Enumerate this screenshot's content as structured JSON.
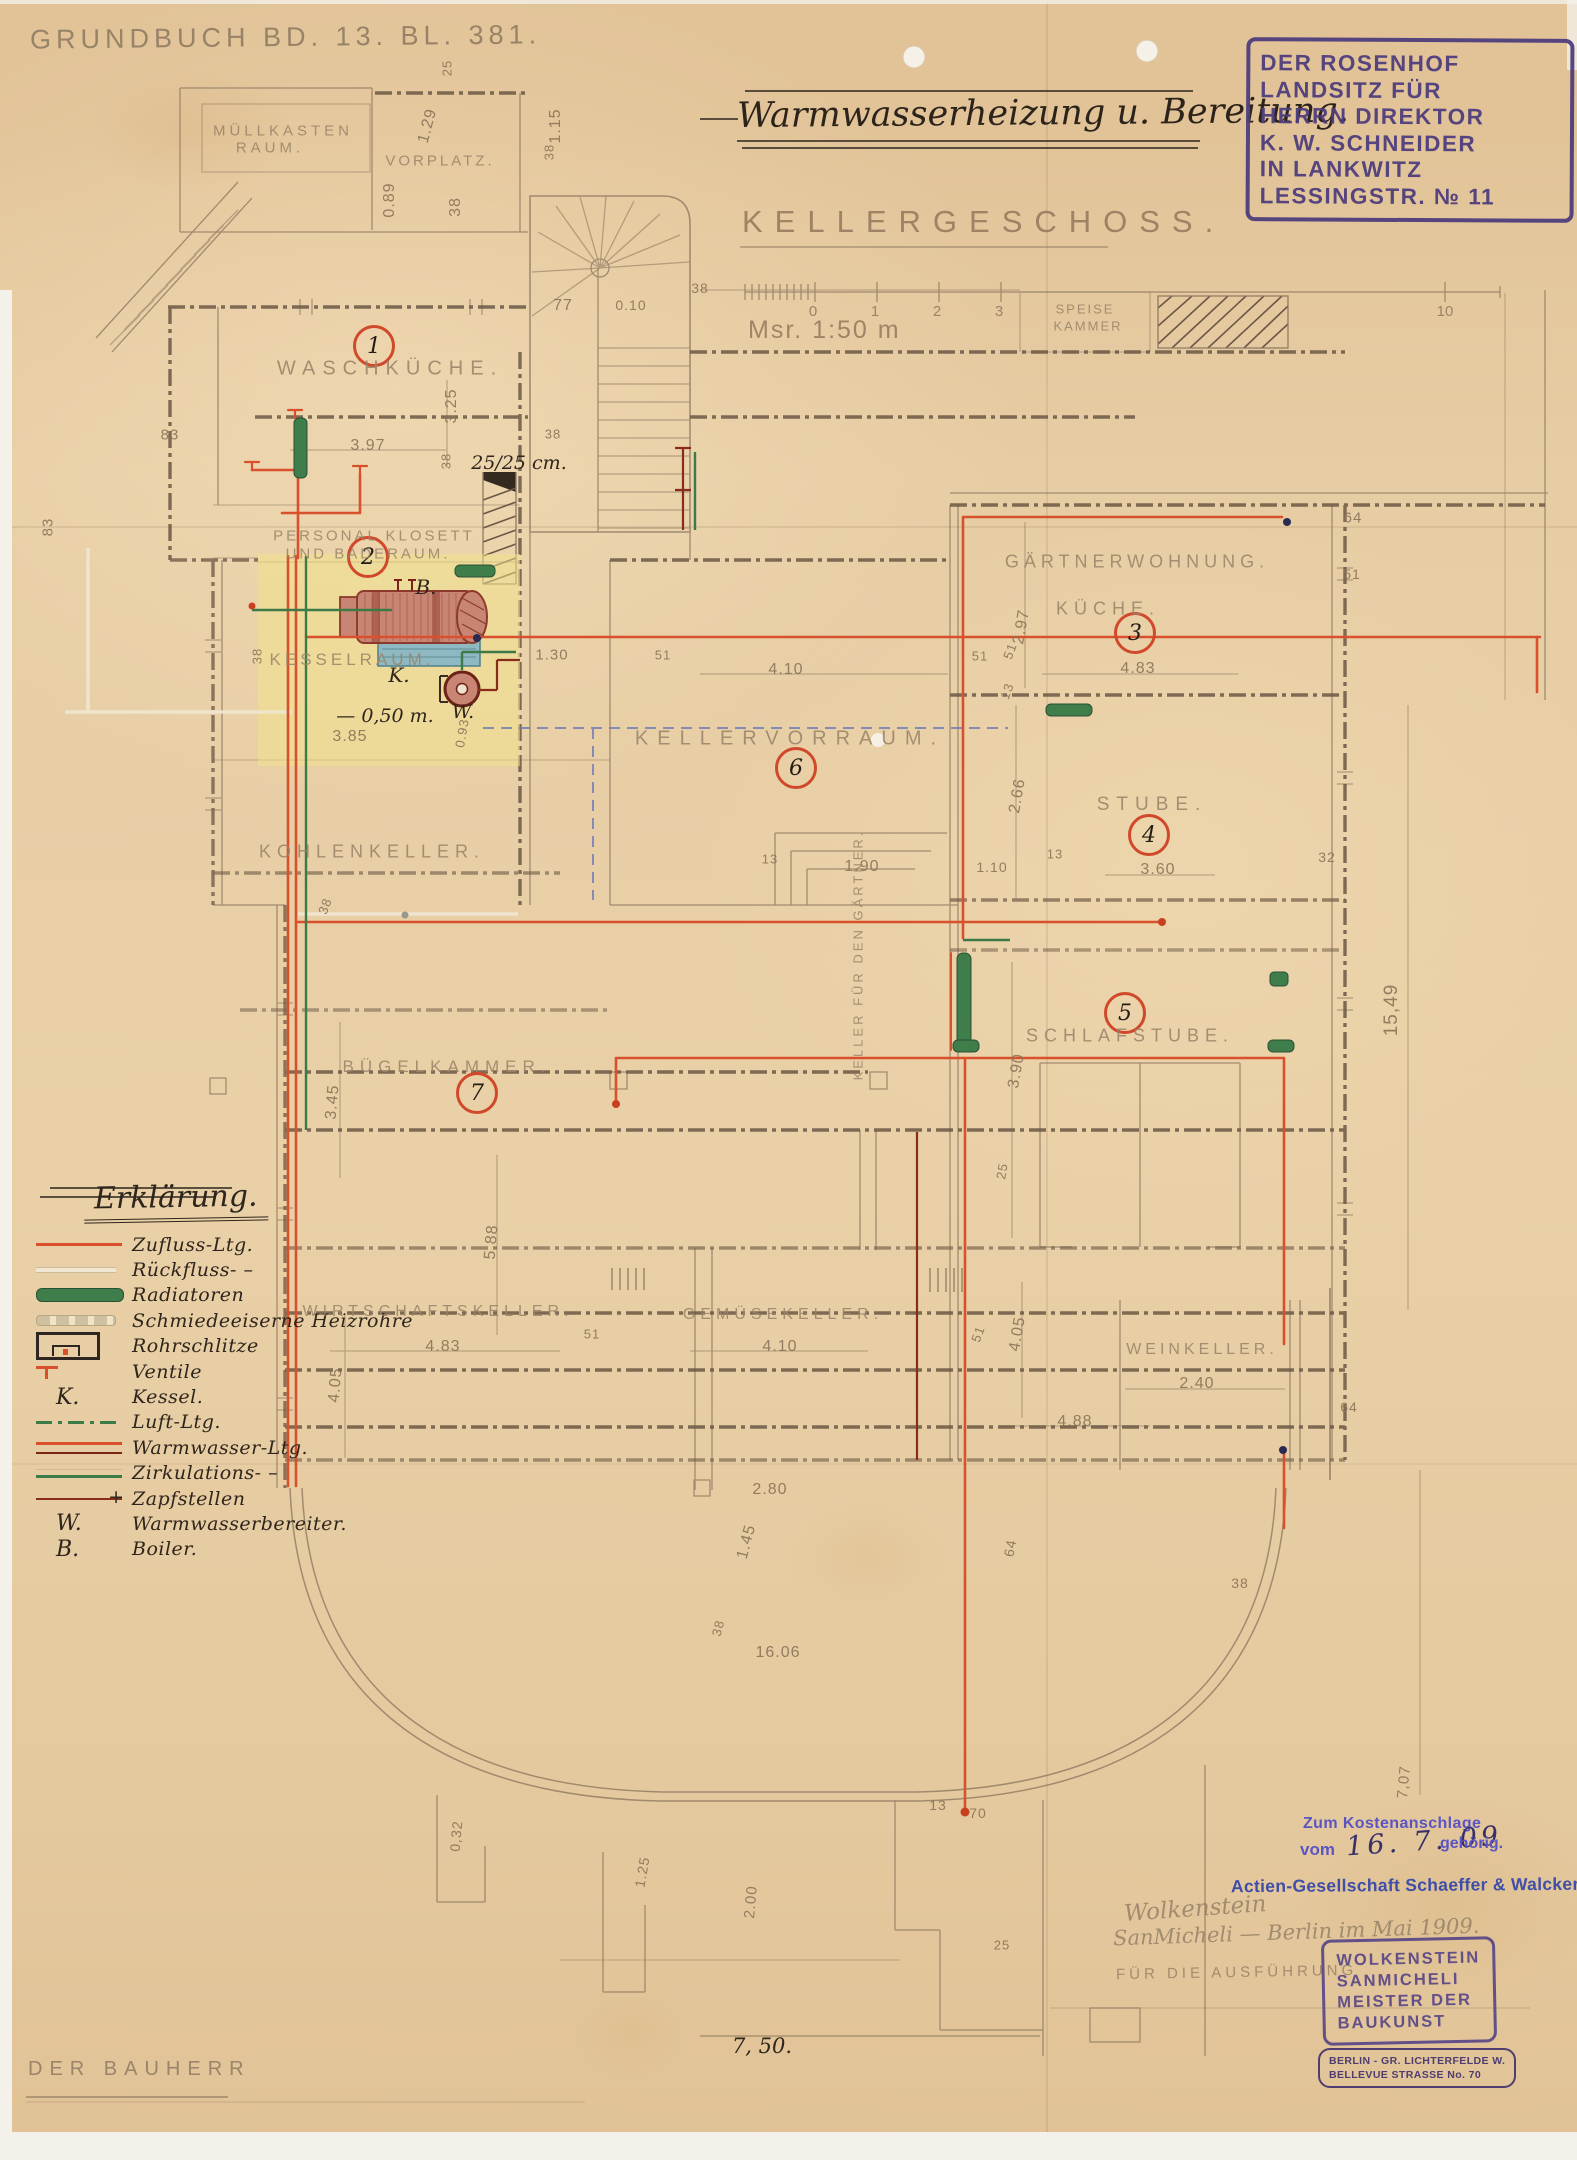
{
  "meta": {
    "grundbuch": "Grundbuch Bd. 13. Bl. 381.",
    "bauherr": "Der Bauherr"
  },
  "title": {
    "main": "Warmwasserheizung u. Bereitung.",
    "floor": "Kellergeschoss.",
    "scale": "Msr. 1:50 m",
    "scale_ticks": [
      {
        "t": "0",
        "x": 813
      },
      {
        "t": "1",
        "x": 875
      },
      {
        "t": "2",
        "x": 937
      },
      {
        "t": "3",
        "x": 999
      },
      {
        "t": "10",
        "x": 1445
      }
    ]
  },
  "owner_stamp": {
    "lines": [
      "DER ROSENHOF",
      "LANDSITZ FÜR",
      "HERRN DIREKTOR",
      "K. W. SCHNEIDER",
      "IN LANKWITZ",
      "LESSINGSTR. № 11"
    ]
  },
  "legend": {
    "title": "Erklärung.",
    "items": [
      {
        "sym": "line-red",
        "label": "Zufluss-Ltg."
      },
      {
        "sym": "line-ghost",
        "label": "Rückfluss- –"
      },
      {
        "sym": "bar-green",
        "label": "Radiatoren"
      },
      {
        "sym": "bar-gray",
        "label": "Schmiedeeiserne Heizrohre"
      },
      {
        "sym": "slit",
        "label": "Rohrschlitze"
      },
      {
        "sym": "valve",
        "label": "Ventile"
      },
      {
        "sym": "letter",
        "glyph": "K.",
        "label": "Kessel."
      },
      {
        "sym": "dashdot-green",
        "label": "Luft-Ltg."
      },
      {
        "sym": "line-red-dark",
        "label": "Warmwasser-Ltg."
      },
      {
        "sym": "line-green",
        "label": "Zirkulations- –"
      },
      {
        "sym": "tap",
        "label": "Zapfstellen"
      },
      {
        "sym": "letter",
        "glyph": "W.",
        "label": "Warmwasserbereiter."
      },
      {
        "sym": "letter",
        "glyph": "B.",
        "label": "Boiler."
      }
    ]
  },
  "plan": {
    "room_circles": [
      {
        "n": "1",
        "x": 374,
        "y": 346
      },
      {
        "n": "2",
        "x": 368,
        "y": 557
      },
      {
        "n": "3",
        "x": 1135,
        "y": 633
      },
      {
        "n": "4",
        "x": 1149,
        "y": 835
      },
      {
        "n": "5",
        "x": 1125,
        "y": 1013
      },
      {
        "n": "6",
        "x": 796,
        "y": 768
      },
      {
        "n": "7",
        "x": 477,
        "y": 1093
      }
    ],
    "room_labels": [
      {
        "t": "Müllkasten",
        "x": 283,
        "y": 131,
        "s": 15,
        "ls": 4
      },
      {
        "t": "Raum.",
        "x": 270,
        "y": 148,
        "s": 15,
        "ls": 4
      },
      {
        "t": "Vorplatz.",
        "x": 440,
        "y": 161,
        "s": 15,
        "ls": 3
      },
      {
        "t": "Waschküche.",
        "x": 390,
        "y": 369,
        "s": 20,
        "ls": 7
      },
      {
        "t": "Personal Klosett",
        "x": 374,
        "y": 536,
        "s": 15,
        "ls": 3
      },
      {
        "t": "und Baderaum.",
        "x": 368,
        "y": 554,
        "s": 15,
        "ls": 3
      },
      {
        "t": "Kesselraum.",
        "x": 352,
        "y": 660,
        "s": 17,
        "ls": 4
      },
      {
        "t": "Kohlenkeller.",
        "x": 372,
        "y": 852,
        "s": 18,
        "ls": 6
      },
      {
        "t": "Kellervorraum.",
        "x": 790,
        "y": 739,
        "s": 20,
        "ls": 9
      },
      {
        "t": "Gärtnerwohnung.",
        "x": 1137,
        "y": 562,
        "s": 18,
        "ls": 5
      },
      {
        "t": "Küche.",
        "x": 1108,
        "y": 609,
        "s": 18,
        "ls": 6
      },
      {
        "t": "Speise",
        "x": 1085,
        "y": 309,
        "s": 13,
        "ls": 2
      },
      {
        "t": "Kammer",
        "x": 1088,
        "y": 326,
        "s": 13,
        "ls": 2
      },
      {
        "t": "Stube.",
        "x": 1152,
        "y": 805,
        "s": 19,
        "ls": 7
      },
      {
        "t": "Schlafstube.",
        "x": 1130,
        "y": 1036,
        "s": 18,
        "ls": 6
      },
      {
        "t": "Bügelkammer.",
        "x": 447,
        "y": 1067,
        "s": 17,
        "ls": 6
      },
      {
        "t": "Wirtschaftskeller.",
        "x": 438,
        "y": 1312,
        "s": 16,
        "ls": 5
      },
      {
        "t": "Gemüsekeller.",
        "x": 783,
        "y": 1315,
        "s": 16,
        "ls": 5
      },
      {
        "t": "Weinkeller.",
        "x": 1202,
        "y": 1350,
        "s": 16,
        "ls": 4
      },
      {
        "t": "Keller für den Gärtner.",
        "x": 858,
        "y": 955,
        "s": 13,
        "ls": 3,
        "r": -90
      }
    ],
    "dimensions": [
      {
        "t": "0.89",
        "x": 390,
        "y": 200,
        "r": -90
      },
      {
        "t": "1.29",
        "x": 428,
        "y": 126,
        "r": -75
      },
      {
        "t": "25",
        "x": 447,
        "y": 68,
        "r": -90,
        "s": 13
      },
      {
        "t": "38",
        "x": 456,
        "y": 207,
        "r": -90
      },
      {
        "t": "1.15",
        "x": 556,
        "y": 126,
        "r": -90
      },
      {
        "t": "38",
        "x": 549,
        "y": 152,
        "r": -90,
        "s": 13
      },
      {
        "t": "77",
        "x": 563,
        "y": 306
      },
      {
        "t": "0.10",
        "x": 631,
        "y": 305,
        "s": 14
      },
      {
        "t": "38",
        "x": 700,
        "y": 288,
        "s": 14
      },
      {
        "t": "83",
        "x": 170,
        "y": 435,
        "s": 15
      },
      {
        "t": "83",
        "x": 48,
        "y": 527,
        "r": -90,
        "s": 15
      },
      {
        "t": "3.97",
        "x": 368,
        "y": 446
      },
      {
        "t": "3.25",
        "x": 452,
        "y": 406,
        "r": -90
      },
      {
        "t": "38",
        "x": 446,
        "y": 461,
        "r": -90,
        "s": 13
      },
      {
        "t": "38",
        "x": 553,
        "y": 434,
        "s": 13
      },
      {
        "t": "38",
        "x": 257,
        "y": 656,
        "r": -90,
        "s": 13
      },
      {
        "t": "3.85",
        "x": 350,
        "y": 737
      },
      {
        "t": "1.30",
        "x": 552,
        "y": 655,
        "s": 15
      },
      {
        "t": "0.93",
        "x": 462,
        "y": 733,
        "r": -80,
        "s": 13
      },
      {
        "t": "2.97",
        "x": 1022,
        "y": 627,
        "r": -80
      },
      {
        "t": "4.83",
        "x": 1138,
        "y": 669
      },
      {
        "t": "51",
        "x": 1010,
        "y": 651,
        "r": -70,
        "s": 13
      },
      {
        "t": "13",
        "x": 1007,
        "y": 691,
        "r": -70,
        "s": 13
      },
      {
        "t": "64",
        "x": 1353,
        "y": 518,
        "s": 15
      },
      {
        "t": "51",
        "x": 1352,
        "y": 574,
        "s": 14
      },
      {
        "t": "4.10",
        "x": 786,
        "y": 670
      },
      {
        "t": "51",
        "x": 663,
        "y": 655,
        "s": 13
      },
      {
        "t": "51",
        "x": 980,
        "y": 656,
        "s": 13
      },
      {
        "t": "1.90",
        "x": 862,
        "y": 867
      },
      {
        "t": "13",
        "x": 770,
        "y": 859,
        "s": 13
      },
      {
        "t": "1.10",
        "x": 992,
        "y": 867,
        "s": 14
      },
      {
        "t": "2.66",
        "x": 1018,
        "y": 796,
        "r": -80
      },
      {
        "t": "13",
        "x": 1055,
        "y": 854,
        "s": 13
      },
      {
        "t": "3.60",
        "x": 1158,
        "y": 870
      },
      {
        "t": "32",
        "x": 1327,
        "y": 857,
        "s": 14
      },
      {
        "t": "3.90",
        "x": 1017,
        "y": 1071,
        "r": -80
      },
      {
        "t": "25",
        "x": 1002,
        "y": 1171,
        "r": -80,
        "s": 13
      },
      {
        "t": "3.45",
        "x": 333,
        "y": 1102,
        "r": -85
      },
      {
        "t": "38",
        "x": 325,
        "y": 906,
        "r": -70,
        "s": 13
      },
      {
        "t": "4.83",
        "x": 443,
        "y": 1347
      },
      {
        "t": "51",
        "x": 592,
        "y": 1334,
        "s": 13
      },
      {
        "t": "4.05",
        "x": 336,
        "y": 1385,
        "r": -85
      },
      {
        "t": "4.10",
        "x": 780,
        "y": 1347
      },
      {
        "t": "51",
        "x": 978,
        "y": 1334,
        "r": -70,
        "s": 13
      },
      {
        "t": "4.05",
        "x": 1018,
        "y": 1334,
        "r": -80
      },
      {
        "t": "2.40",
        "x": 1197,
        "y": 1384
      },
      {
        "t": "4.88",
        "x": 1075,
        "y": 1422
      },
      {
        "t": "64",
        "x": 1349,
        "y": 1407,
        "s": 14
      },
      {
        "t": "15,49",
        "x": 1392,
        "y": 1010,
        "r": -90,
        "s": 19
      },
      {
        "t": "5.88",
        "x": 492,
        "y": 1242,
        "r": -85
      },
      {
        "t": "2.80",
        "x": 770,
        "y": 1490
      },
      {
        "t": "1.45",
        "x": 747,
        "y": 1542,
        "r": -75
      },
      {
        "t": "38",
        "x": 718,
        "y": 1628,
        "r": -75,
        "s": 13
      },
      {
        "t": "16.06",
        "x": 778,
        "y": 1653
      },
      {
        "t": "64",
        "x": 1010,
        "y": 1548,
        "r": -80,
        "s": 14
      },
      {
        "t": "38",
        "x": 1240,
        "y": 1583,
        "s": 14
      },
      {
        "t": "13",
        "x": 938,
        "y": 1805,
        "s": 14
      },
      {
        "t": "70",
        "x": 978,
        "y": 1813,
        "s": 14
      },
      {
        "t": "25",
        "x": 1002,
        "y": 1945,
        "s": 13
      },
      {
        "t": "0,32",
        "x": 456,
        "y": 1836,
        "r": -85,
        "s": 14
      },
      {
        "t": "1.25",
        "x": 642,
        "y": 1872,
        "r": -80,
        "s": 14
      },
      {
        "t": "2.00",
        "x": 751,
        "y": 1902,
        "r": -85,
        "s": 15
      },
      {
        "t": "7,07",
        "x": 1404,
        "y": 1782,
        "r": -85,
        "s": 15
      }
    ],
    "annotations": [
      {
        "t": "25/25 cm.",
        "x": 519,
        "y": 463,
        "s": 19
      },
      {
        "t": "— 0,50 m.",
        "x": 385,
        "y": 716,
        "s": 19
      },
      {
        "t": "B.",
        "x": 426,
        "y": 587,
        "s": 20
      },
      {
        "t": "K.",
        "x": 399,
        "y": 675,
        "s": 20
      },
      {
        "t": "W.",
        "x": 463,
        "y": 712,
        "s": 19
      },
      {
        "t": "7, 50.",
        "x": 762,
        "y": 2046,
        "s": 21
      }
    ]
  },
  "stamps": {
    "kosten_line1": "Zum Kostenanschlage",
    "kosten_vom": "vom",
    "kosten_date": "16. 7. 09",
    "kosten_gehoerig": "gehörig.",
    "firm": "Actien-Gesellschaft Schaeffer & Walcker",
    "signature1": "Wolkenstein",
    "signature2": "SanMicheli — Berlin im Mai 1909.",
    "execution_note": "Für die Ausführung",
    "master_lines": [
      "WOLKENSTEIN",
      "SANMICHELI",
      "MEISTER DER",
      "BAUKUNST"
    ],
    "address_lines": [
      "BERLIN - GR. LICHTERFELDE W.",
      "BELLEVUE STRASSE No. 70"
    ]
  },
  "colors": {
    "supply_red": "#d9512c",
    "dark_red": "#8a2c1a",
    "circulation_green": "#3c7a47",
    "air_blue": "#6d79b8",
    "stamp_purple": "#4c3c7c",
    "stamp_blue": "#3f4fa8",
    "pencil": "#8f7b62",
    "paper": "#e7cda4"
  }
}
